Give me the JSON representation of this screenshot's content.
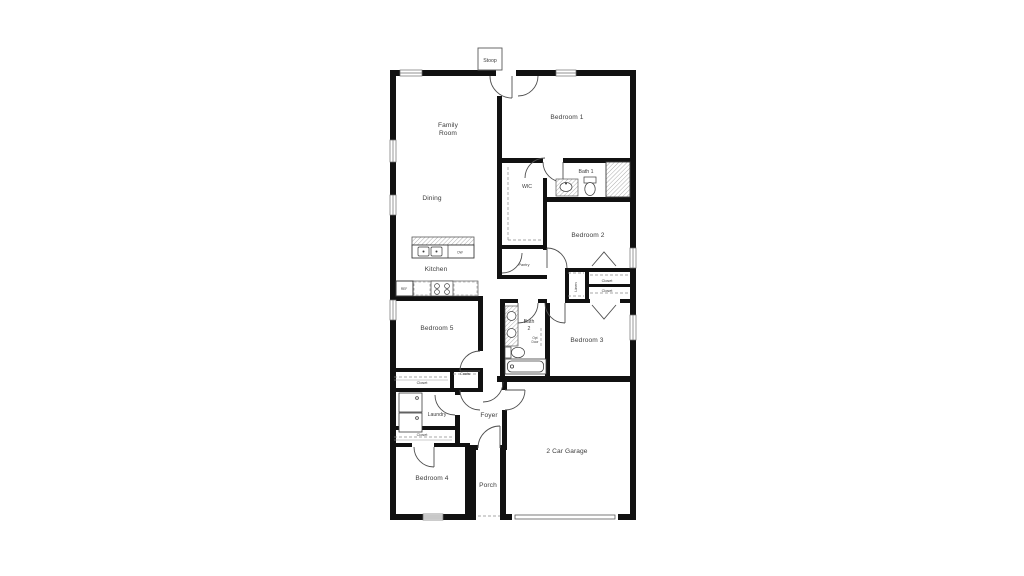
{
  "page": {
    "background": "#ffffff",
    "description": "Residential single-story floor plan drawing centered on white canvas"
  },
  "floorplan": {
    "colors": {
      "wall": "#111111",
      "line": "#4f4f4f",
      "thin": "#777777",
      "text": "#3c3c3c",
      "background": "#ffffff"
    },
    "labels": {
      "stoop": "Stoop",
      "family_room": [
        "Family",
        "Room"
      ],
      "bedroom1": "Bedroom 1",
      "wic": "WIC",
      "bath1": "Bath 1",
      "dining": "Dining",
      "bedroom2": "Bedroom 2",
      "kitchen": "Kitchen",
      "pantry": "Pantry",
      "linen": "Linen",
      "closet_bedroom2": "Closet",
      "closet_bedroom3": "Closet",
      "bedroom5": "Bedroom 5",
      "bath2": [
        "Bath",
        "2"
      ],
      "opt_door": [
        "Opt",
        "Door"
      ],
      "bedroom3": "Bedroom 3",
      "coats": "Coats",
      "closet_bedroom5": "Closet",
      "laundry": "Laundry",
      "foyer": "Foyer",
      "closet_hall": "Closet",
      "bedroom4": "Bedroom 4",
      "porch": "Porch",
      "garage": "2 Car Garage",
      "ref": "REF",
      "dw": "DW"
    },
    "fixtures": [
      "kitchen-island-sink",
      "dishwasher",
      "range",
      "refrigerator",
      "bath1-vanity-sink",
      "bath1-toilet",
      "bath1-shower",
      "bath2-double-vanity",
      "bath2-toilet",
      "bath2-tub",
      "washer",
      "dryer",
      "garage-door",
      "front-door",
      "entry-door",
      "windows"
    ]
  }
}
